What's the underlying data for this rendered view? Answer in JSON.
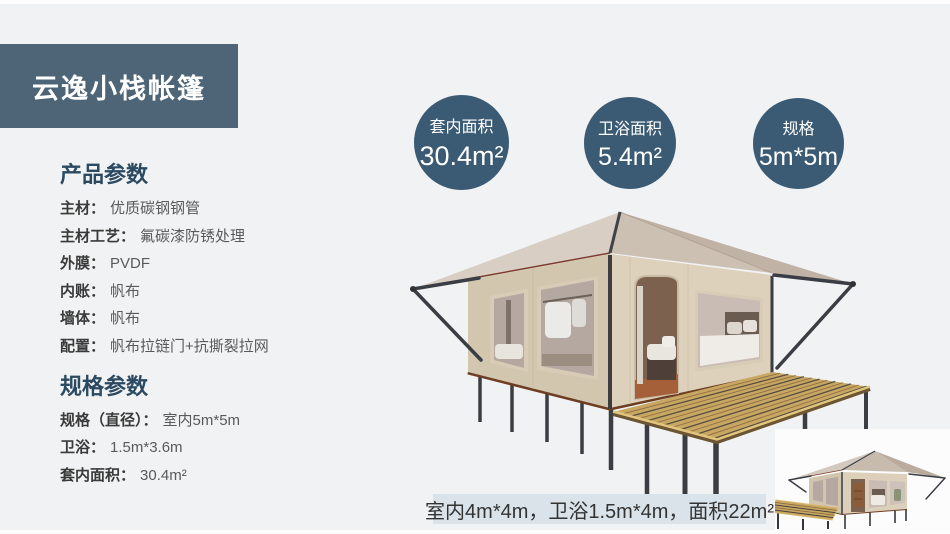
{
  "colors": {
    "page_bg": "#f1f2f3",
    "banner_bg": "#4e6578",
    "badge_bg": "#3b5a73",
    "heading": "#2b4a61",
    "label": "#3a3a3a",
    "value": "#5a5a5a",
    "caption_bg": "#d9e3e9",
    "caption_text": "#333333"
  },
  "banner": {
    "title": "云逸小栈帐篷"
  },
  "product_params": {
    "heading": "产品参数",
    "rows": [
      {
        "label": "主材：",
        "value": "优质碳钢钢管"
      },
      {
        "label": "主材工艺：",
        "value": "氟碳漆防锈处理"
      },
      {
        "label": "外膜：",
        "value": "PVDF"
      },
      {
        "label": "内账：",
        "value": "帆布"
      },
      {
        "label": "墙体：",
        "value": "帆布"
      },
      {
        "label": "配置：",
        "value": "帆布拉链门+抗撕裂拉网"
      }
    ]
  },
  "spec_params": {
    "heading": "规格参数",
    "rows": [
      {
        "label": "规格（直径）：",
        "value": "室内5m*5m"
      },
      {
        "label": "卫浴：",
        "value": "1.5m*3.6m"
      },
      {
        "label": "套内面积：",
        "value": "30.4m²"
      }
    ]
  },
  "badges": [
    {
      "label": "套内面积",
      "value": "30.4m²"
    },
    {
      "label": "卫浴面积",
      "value": "5.4m²"
    },
    {
      "label": "规格",
      "value": "5m*5m"
    }
  ],
  "variant": {
    "caption": "室内4m*4m，卫浴1.5m*4m，面积22m²"
  },
  "images": {
    "main_tent": "safari-glamping-tent-3d-render",
    "variant_tent": "small-tent-variant-3d-render"
  }
}
